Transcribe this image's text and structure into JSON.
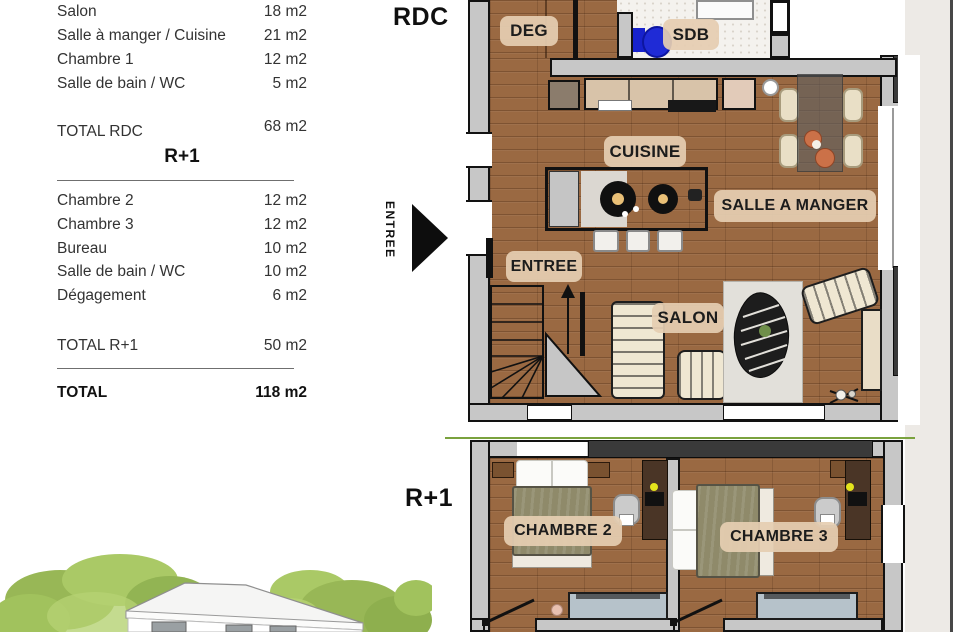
{
  "area_table": {
    "rdc_rows": [
      {
        "label": "Salon",
        "value": "18 m2"
      },
      {
        "label": "Salle à manger / Cuisine",
        "value": "21 m2"
      },
      {
        "label": "Chambre 1",
        "value": "12 m2"
      },
      {
        "label": "Salle de bain / WC",
        "value": "5 m2"
      }
    ],
    "total_rdc": {
      "label": "TOTAL RDC",
      "value": "68 m2"
    },
    "r1_header": "R+1",
    "r1_rows": [
      {
        "label": "Chambre 2",
        "value": "12 m2"
      },
      {
        "label": "Chambre 3",
        "value": "12 m2"
      },
      {
        "label": "Bureau",
        "value": "10 m2"
      },
      {
        "label": "Salle de bain / WC",
        "value": "10 m2"
      },
      {
        "label": "Dégagement",
        "value": "6 m2"
      }
    ],
    "total_r1": {
      "label": "TOTAL R+1",
      "value": "50 m2"
    },
    "total": {
      "label": "TOTAL",
      "value": "118 m2"
    }
  },
  "plan_rdc": {
    "title": "RDC",
    "entry_label": "ENTREE",
    "room_labels": {
      "deg": "DEG",
      "sdb": "SDB",
      "cuisine": "CUISINE",
      "salle_a_manger": "SALLE A MANGER",
      "entree": "ENTREE",
      "salon": "SALON"
    }
  },
  "plan_r1": {
    "title": "R+1",
    "room_labels": {
      "chambre2": "CHAMBRE 2",
      "chambre3": "CHAMBRE 3"
    }
  },
  "colors": {
    "wood": "#9a6942",
    "wall_gray": "#c7c7c7",
    "wall_dark": "#3a3a3a",
    "label_pill": "#e5cdb1",
    "toilet_blue": "#1f2bd6",
    "bed_olive": "#8f8a6a",
    "radiator_blue": "#b6c2ca",
    "foliage_green": "#9dbf55",
    "page_band": "#edeae6"
  }
}
